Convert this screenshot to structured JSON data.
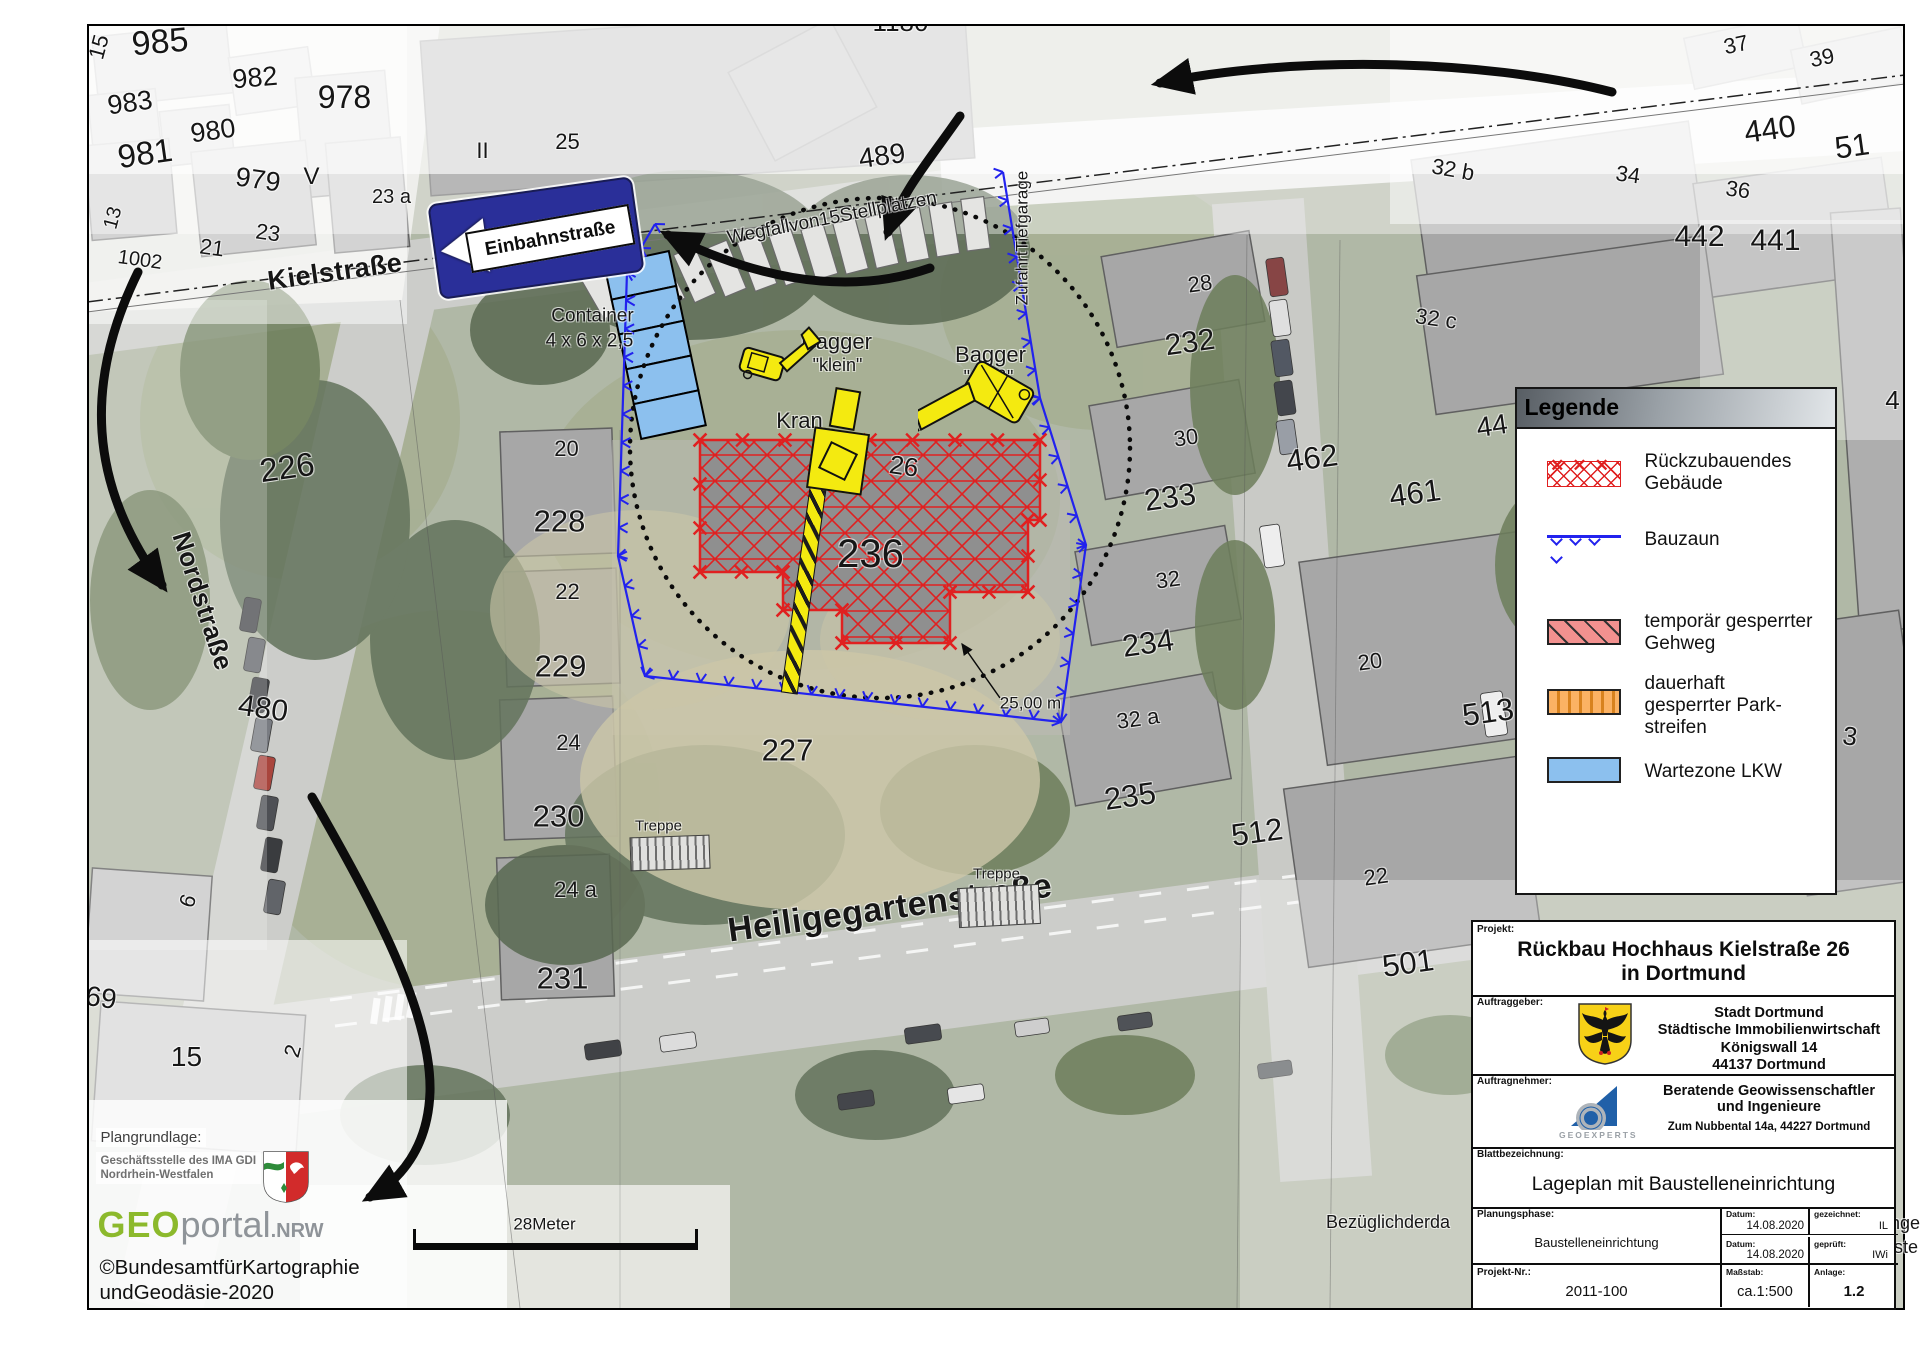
{
  "colors": {
    "fence_blue": "#2222ee",
    "demo_red": "#e02020",
    "machine_yellow": "#f4ea10",
    "wait_blue": "#8cc0ee",
    "sign_blue": "#2a2f99",
    "walk_pink": "#f2918f",
    "park_orange": "#fbb264"
  },
  "map": {
    "sign_text": "Einbahnstraße",
    "parcel_labels": [
      {
        "t": "985",
        "x": 160,
        "y": 42,
        "s": 34,
        "r": -5
      },
      {
        "t": "15",
        "x": 99,
        "y": 47,
        "s": 22,
        "r": -75
      },
      {
        "t": "982",
        "x": 255,
        "y": 78,
        "s": 27,
        "r": -5
      },
      {
        "t": "978",
        "x": 345,
        "y": 97,
        "s": 32,
        "r": 0
      },
      {
        "t": "983",
        "x": 130,
        "y": 103,
        "s": 27,
        "r": -8
      },
      {
        "t": "980",
        "x": 213,
        "y": 131,
        "s": 27,
        "r": -8
      },
      {
        "t": "981",
        "x": 145,
        "y": 153,
        "s": 33,
        "r": -8
      },
      {
        "t": "979",
        "x": 258,
        "y": 180,
        "s": 27,
        "r": 8
      },
      {
        "t": "V",
        "x": 312,
        "y": 177,
        "s": 24,
        "r": 0
      },
      {
        "t": "23 a",
        "x": 392,
        "y": 197,
        "s": 20,
        "r": 0
      },
      {
        "t": "13",
        "x": 113,
        "y": 218,
        "s": 20,
        "r": -75
      },
      {
        "t": "23",
        "x": 268,
        "y": 233,
        "s": 22,
        "r": 8
      },
      {
        "t": "21",
        "x": 212,
        "y": 248,
        "s": 22,
        "r": 8
      },
      {
        "t": "1002",
        "x": 140,
        "y": 260,
        "s": 20,
        "r": 8
      },
      {
        "t": "II",
        "x": 483,
        "y": 151,
        "s": 22,
        "r": 0
      },
      {
        "t": "25",
        "x": 568,
        "y": 142,
        "s": 22,
        "r": 0
      },
      {
        "t": "1180",
        "x": 901,
        "y": 22,
        "s": 26,
        "r": 0
      },
      {
        "t": "489",
        "x": 882,
        "y": 156,
        "s": 28,
        "r": -8
      },
      {
        "t": "37",
        "x": 1736,
        "y": 45,
        "s": 22,
        "r": -12
      },
      {
        "t": "39",
        "x": 1822,
        "y": 58,
        "s": 22,
        "r": -12
      },
      {
        "t": "440",
        "x": 1770,
        "y": 129,
        "s": 31,
        "r": -8
      },
      {
        "t": "51",
        "x": 1852,
        "y": 146,
        "s": 31,
        "r": -8
      },
      {
        "t": "32 b",
        "x": 1453,
        "y": 170,
        "s": 22,
        "r": 10
      },
      {
        "t": "34",
        "x": 1628,
        "y": 175,
        "s": 22,
        "r": 8
      },
      {
        "t": "36",
        "x": 1738,
        "y": 190,
        "s": 22,
        "r": 8
      },
      {
        "t": "442",
        "x": 1700,
        "y": 237,
        "s": 30,
        "r": 0
      },
      {
        "t": "441",
        "x": 1776,
        "y": 241,
        "s": 30,
        "r": 0
      },
      {
        "t": "32 c",
        "x": 1436,
        "y": 319,
        "s": 22,
        "r": 8
      },
      {
        "t": "28",
        "x": 1200,
        "y": 284,
        "s": 22,
        "r": -8
      },
      {
        "t": "232",
        "x": 1190,
        "y": 343,
        "s": 30,
        "r": -8
      },
      {
        "t": "462",
        "x": 1312,
        "y": 458,
        "s": 31,
        "r": -8
      },
      {
        "t": "30",
        "x": 1186,
        "y": 438,
        "s": 22,
        "r": -8
      },
      {
        "t": "233",
        "x": 1170,
        "y": 497,
        "s": 31,
        "r": -8
      },
      {
        "t": "461",
        "x": 1415,
        "y": 493,
        "s": 31,
        "r": -8
      },
      {
        "t": "44",
        "x": 1492,
        "y": 426,
        "s": 28,
        "r": -8
      },
      {
        "t": "32",
        "x": 1168,
        "y": 580,
        "s": 22,
        "r": -8
      },
      {
        "t": "234",
        "x": 1148,
        "y": 643,
        "s": 31,
        "r": -8
      },
      {
        "t": "20",
        "x": 1370,
        "y": 662,
        "s": 22,
        "r": -8
      },
      {
        "t": "513",
        "x": 1488,
        "y": 712,
        "s": 31,
        "r": -8
      },
      {
        "t": "32 a",
        "x": 1138,
        "y": 719,
        "s": 22,
        "r": -8
      },
      {
        "t": "235",
        "x": 1130,
        "y": 796,
        "s": 31,
        "r": -8
      },
      {
        "t": "512",
        "x": 1257,
        "y": 832,
        "s": 31,
        "r": -8
      },
      {
        "t": "22",
        "x": 1376,
        "y": 877,
        "s": 22,
        "r": -8
      },
      {
        "t": "501",
        "x": 1408,
        "y": 963,
        "s": 31,
        "r": -8
      },
      {
        "t": "3",
        "x": 1850,
        "y": 736,
        "s": 26,
        "r": 8
      },
      {
        "t": "4",
        "x": 1893,
        "y": 400,
        "s": 26,
        "r": 0
      },
      {
        "t": "226",
        "x": 287,
        "y": 467,
        "s": 33,
        "r": -8
      },
      {
        "t": "20",
        "x": 567,
        "y": 449,
        "s": 22,
        "r": 0
      },
      {
        "t": "228",
        "x": 560,
        "y": 521,
        "s": 31,
        "r": 0
      },
      {
        "t": "22",
        "x": 568,
        "y": 592,
        "s": 22,
        "r": 0
      },
      {
        "t": "229",
        "x": 561,
        "y": 666,
        "s": 31,
        "r": 0
      },
      {
        "t": "24",
        "x": 569,
        "y": 743,
        "s": 22,
        "r": 0
      },
      {
        "t": "230",
        "x": 559,
        "y": 816,
        "s": 31,
        "r": 0
      },
      {
        "t": "24 a",
        "x": 576,
        "y": 890,
        "s": 22,
        "r": 0
      },
      {
        "t": "231",
        "x": 563,
        "y": 978,
        "s": 31,
        "r": 0
      },
      {
        "t": "480",
        "x": 263,
        "y": 709,
        "s": 30,
        "r": 8
      },
      {
        "t": "69",
        "x": 101,
        "y": 998,
        "s": 28,
        "r": 8
      },
      {
        "t": "6",
        "x": 188,
        "y": 901,
        "s": 22,
        "r": -70
      },
      {
        "t": "15",
        "x": 187,
        "y": 1057,
        "s": 28,
        "r": 0
      },
      {
        "t": "2",
        "x": 293,
        "y": 1051,
        "s": 22,
        "r": -75
      },
      {
        "t": "227",
        "x": 788,
        "y": 750,
        "s": 31,
        "r": 0
      },
      {
        "t": "26",
        "x": 904,
        "y": 466,
        "s": 26,
        "r": 8
      },
      {
        "t": "236",
        "x": 871,
        "y": 554,
        "s": 40,
        "r": 0
      }
    ],
    "street_labels": [
      {
        "t": "Kielstraße",
        "x": 335,
        "y": 272,
        "s": 27,
        "r": -8
      },
      {
        "t": "Nordstraße",
        "x": 203,
        "y": 601,
        "s": 26,
        "r": 72
      },
      {
        "t": "Heiligegartenstraße",
        "x": 890,
        "y": 908,
        "s": 34,
        "r": -8
      }
    ],
    "note_labels": [
      {
        "t": "Wegfallvon15Stellplätzen",
        "x": 832,
        "y": 218,
        "s": 19,
        "r": -11
      },
      {
        "t": "ZufahrtTiefgarage",
        "x": 1022,
        "y": 238,
        "s": 17,
        "r": -90
      },
      {
        "t": "Container",
        "x": 593,
        "y": 316,
        "s": 19,
        "r": 0
      },
      {
        "t": "4 x 6 x 2,5",
        "x": 590,
        "y": 341,
        "s": 19,
        "r": 0
      },
      {
        "t": "Bagger",
        "x": 837,
        "y": 342,
        "s": 22,
        "r": 0
      },
      {
        "t": "\"klein\"",
        "x": 838,
        "y": 365,
        "s": 18,
        "r": 0
      },
      {
        "t": "Bagger",
        "x": 991,
        "y": 355,
        "s": 22,
        "r": 0
      },
      {
        "t": "\"groß\"",
        "x": 989,
        "y": 377,
        "s": 18,
        "r": 0
      },
      {
        "t": "Kran",
        "x": 800,
        "y": 421,
        "s": 22,
        "r": 0
      },
      {
        "t": "Treppe",
        "x": 659,
        "y": 826,
        "s": 15,
        "r": 0
      },
      {
        "t": "Treppe",
        "x": 997,
        "y": 874,
        "s": 15,
        "r": 0
      },
      {
        "t": "25,00 m",
        "x": 1031,
        "y": 703,
        "s": 17,
        "r": 0
      },
      {
        "t": "28Meter",
        "x": 545,
        "y": 1224,
        "s": 17,
        "r": 0
      }
    ],
    "fence_path": [
      [
        655,
        224
      ],
      [
        627,
        272
      ],
      [
        618,
        556
      ],
      [
        645,
        676
      ],
      [
        1061,
        722
      ],
      [
        1086,
        545
      ],
      [
        1040,
        398
      ],
      [
        1003,
        172
      ]
    ],
    "building_pts": "700,440 1040,440 1040,520 1028,520 1028,592 950,592 950,643 842,643 842,610 783,610 783,572 700,572",
    "safety_circle": {
      "cx": 880,
      "cy": 448,
      "r": 250
    },
    "radius_leader": {
      "x1": 1000,
      "y1": 698,
      "x2": 962,
      "y2": 644
    },
    "arrow_paths": [
      "M1612,92 C1480,58 1290,56 1160,83",
      "M960,116 C928,162 903,190 888,232",
      "M930,268 C838,300 742,272 668,235",
      "M138,272 C84,382 88,484 162,585",
      "M312,797 C372,902 432,1012 430,1092 C428,1148 400,1180 370,1197"
    ],
    "stalls": {
      "count": 13,
      "x0": 601,
      "y0": 291,
      "dx": 31.2,
      "dy": -5.6,
      "w": 23,
      "h": 52,
      "r0": -30,
      "dr": 1.9
    },
    "container_stack": {
      "x": 622,
      "y": 256,
      "w": 66,
      "cell_h": 35.6,
      "cells": 5,
      "rot": -12
    },
    "cars": [
      [
        1268,
        258,
        18,
        38,
        -8,
        "#7a3030"
      ],
      [
        1271,
        300,
        18,
        36,
        -8,
        "#dcdcdc"
      ],
      [
        1273,
        340,
        18,
        36,
        -8,
        "#3f4652"
      ],
      [
        1276,
        381,
        18,
        34,
        -8,
        "#2e3138"
      ],
      [
        1278,
        420,
        18,
        34,
        -8,
        "#8e949c"
      ],
      [
        1262,
        525,
        20,
        42,
        -8,
        "#ececec"
      ],
      [
        242,
        598,
        17,
        34,
        10,
        "#37393d"
      ],
      [
        246,
        638,
        17,
        34,
        10,
        "#55585e"
      ],
      [
        250,
        678,
        17,
        34,
        10,
        "#2d2f33"
      ],
      [
        253,
        718,
        17,
        34,
        10,
        "#6a6e74"
      ],
      [
        256,
        756,
        17,
        34,
        10,
        "#a03028"
      ],
      [
        259,
        796,
        17,
        34,
        10,
        "#3a3d42"
      ],
      [
        263,
        838,
        17,
        34,
        10,
        "#24262a"
      ],
      [
        266,
        880,
        17,
        34,
        10,
        "#505358"
      ],
      [
        585,
        1042,
        36,
        16,
        -8,
        "#2b2d31"
      ],
      [
        660,
        1034,
        36,
        16,
        -8,
        "#d8d8d8"
      ],
      [
        905,
        1026,
        36,
        16,
        -8,
        "#33363b"
      ],
      [
        1015,
        1020,
        34,
        15,
        -8,
        "#c9c9c9"
      ],
      [
        1118,
        1014,
        34,
        15,
        -8,
        "#3c3f44"
      ],
      [
        838,
        1092,
        36,
        16,
        -8,
        "#2f3237"
      ],
      [
        948,
        1086,
        36,
        16,
        -8,
        "#e2e2e2"
      ],
      [
        1258,
        1062,
        34,
        15,
        -8,
        "#404449"
      ],
      [
        1483,
        692,
        22,
        44,
        -8,
        "#ededed"
      ],
      [
        1600,
        470,
        16,
        32,
        -4,
        "#cfcfcf"
      ],
      [
        1604,
        508,
        16,
        30,
        -4,
        "#4a4d52"
      ]
    ]
  },
  "legend": {
    "title": "Legende",
    "items": [
      {
        "type": "demo",
        "lines": [
          "Rückzubauendes",
          "Gebäude"
        ]
      },
      {
        "type": "fence",
        "lines": [
          "Bauzaun"
        ]
      },
      {
        "type": "walk",
        "lines": [
          "temporär gesperrter",
          "Gehweg"
        ]
      },
      {
        "type": "park",
        "lines": [
          "dauerhaft",
          "gesperrter Park-",
          "streifen"
        ]
      },
      {
        "type": "wait",
        "lines": [
          "Wartezone LKW"
        ]
      }
    ]
  },
  "credits": {
    "plangrundlage": "Plangrundlage:",
    "ima_line1": "Geschäftsstelle des IMA GDI",
    "ima_line2": "Nordrhein-Westfalen",
    "geo": "GEO",
    "portal": "portal",
    "nrw": ".NRW",
    "copy_line1": "©BundesamtfürKartographie",
    "copy_line2": "undGeodäsie-2020"
  },
  "hidden_note": {
    "left": "Bezüglichderda",
    "right_line1": "nger",
    "right_line2": "ste"
  },
  "title_block": {
    "projekt_label": "Projekt:",
    "projekt_line1": "Rückbau Hochhaus Kielstraße 26",
    "projekt_line2": "in Dortmund",
    "auftraggeber_label": "Auftraggeber:",
    "ag_lines": [
      "Stadt Dortmund",
      "Städtische Immobilienwirtschaft",
      "Königswall 14",
      "44137 Dortmund"
    ],
    "auftragnehmer_label": "Auftragnehmer:",
    "an_line1": "Beratende Geowissenschaftler",
    "an_line2": "und Ingenieure",
    "an_line3": "Zum Nubbental 14a,  44227 Dortmund",
    "an_logo_text": "GEOEXPERTS",
    "blatt_label": "Blattbezeichnung:",
    "blatt_value": "Lageplan mit Baustelleneinrichtung",
    "phase_label": "Planungsphase:",
    "phase_value": "Baustelleneinrichtung",
    "datum_label": "Datum:",
    "datum1": "14.08.2020",
    "datum2": "14.08.2020",
    "gez_label": "gezeichnet:",
    "gez_value": "IL",
    "gep_label": "geprüft:",
    "gep_value": "IWi",
    "nr_label": "Projekt-Nr.:",
    "nr_value": "2011-100",
    "massstab_label": "Maßstab:",
    "massstab_value": "ca.1:500",
    "anlage_label": "Anlage:",
    "anlage_value": "1.2"
  }
}
